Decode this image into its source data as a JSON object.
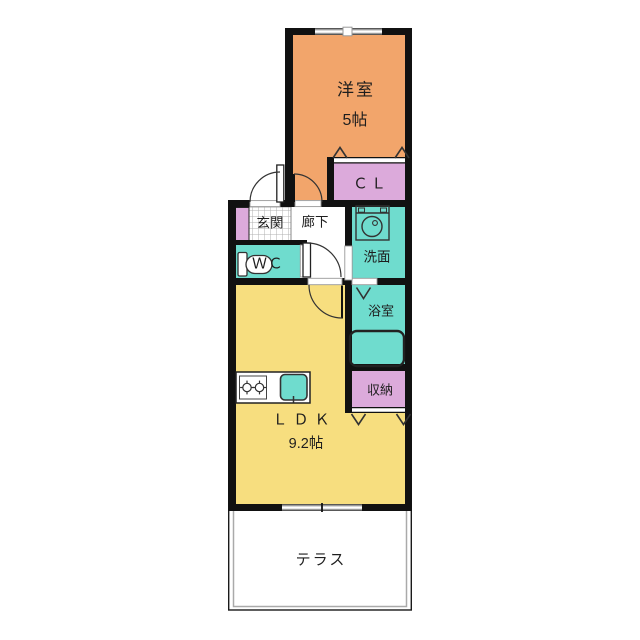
{
  "title": "apartment-floor-plan",
  "rooms": {
    "bedroom": {
      "label": "洋室",
      "size": "5帖"
    },
    "closet": {
      "label": "ＣＬ"
    },
    "entrance": {
      "label": "玄関"
    },
    "hallway": {
      "label": "廊下"
    },
    "washroom": {
      "label": "洗面"
    },
    "toilet": {
      "label": "ＷＣ"
    },
    "bathroom": {
      "label": "浴室"
    },
    "storage": {
      "label": "収納"
    },
    "ldk": {
      "label": "ＬＤＫ",
      "size": "9.2帖"
    },
    "terrace": {
      "label": "テラス"
    }
  },
  "colors": {
    "bedroom": "#F2A56B",
    "closet_storage": "#DCAADB",
    "water": "#6FDCCE",
    "ldk": "#F7DE7F",
    "wall": "#111111",
    "line": "#333333",
    "window_gray": "#999999",
    "terrace_gray": "#AAAAAA"
  },
  "icons": {
    "washer": "washing-machine-icon",
    "toilet": "toilet-icon",
    "bathtub": "bathtub-icon",
    "stove": "stove-burners-icon",
    "sink": "kitchen-sink-icon",
    "door_swing": "door-swing-arc",
    "folding_door": "folding-door-mark",
    "double_door": "double-door-chevron-mark"
  }
}
